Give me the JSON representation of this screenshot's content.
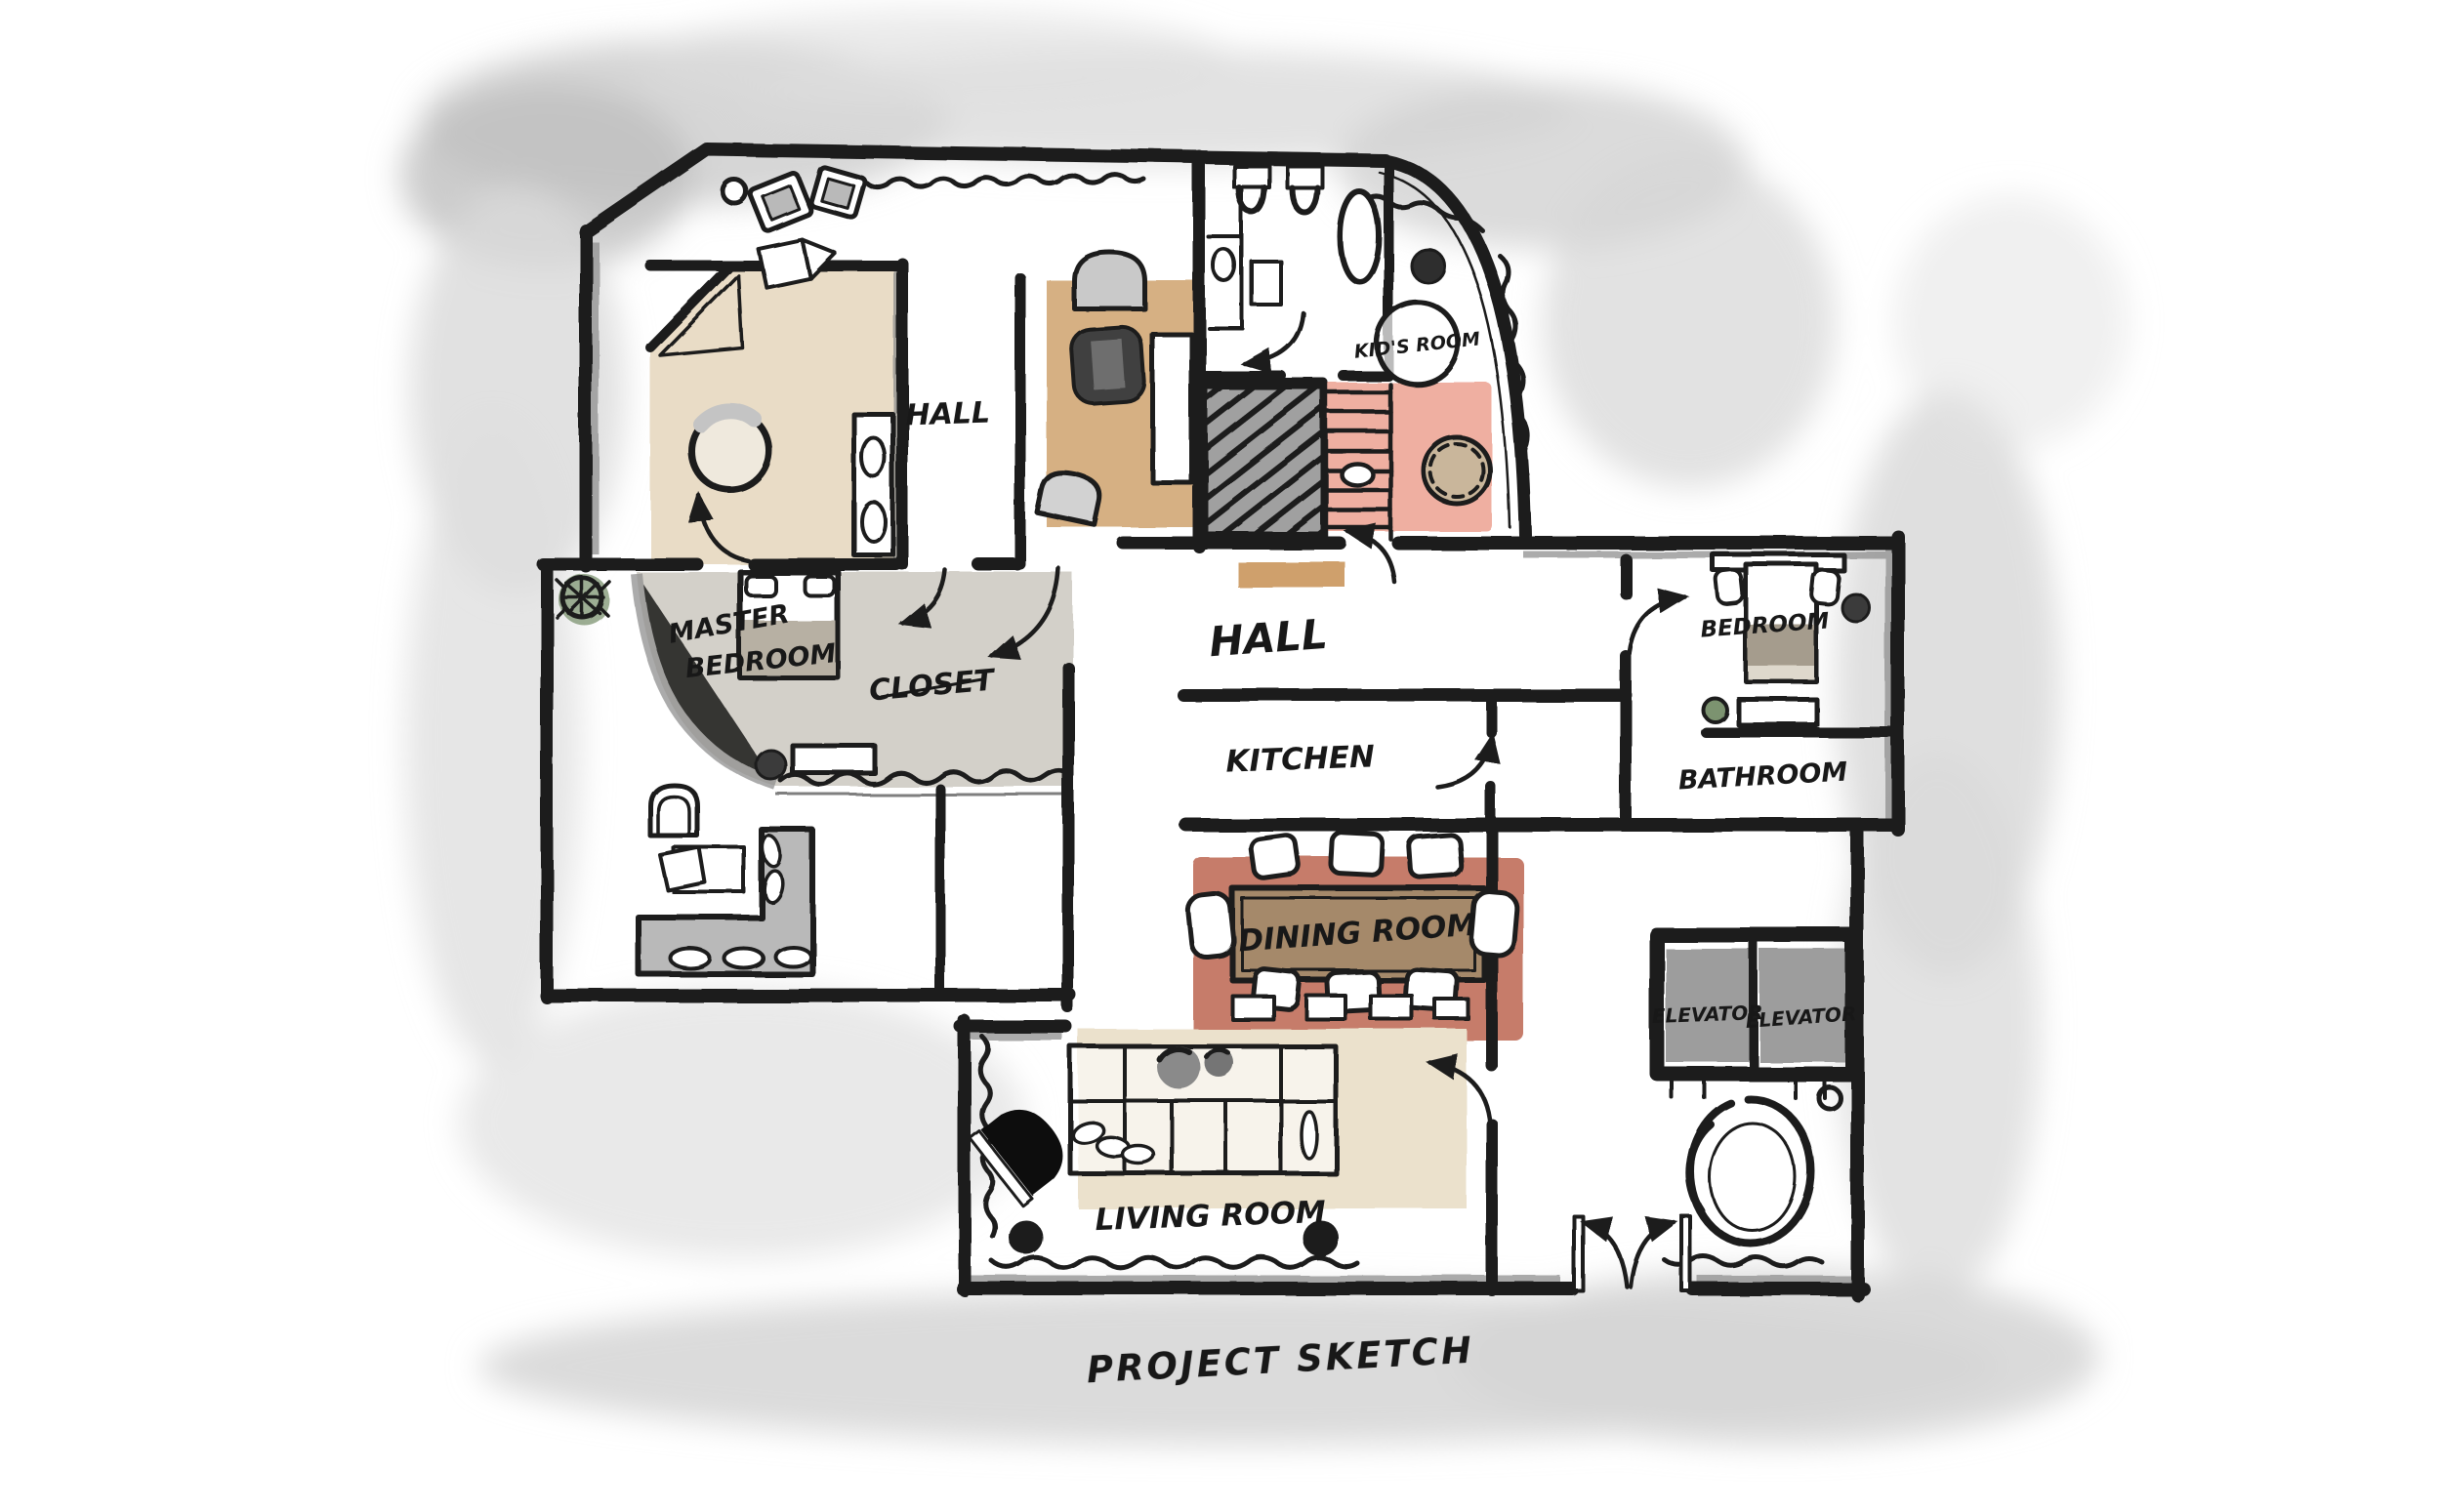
{
  "caption": "PROJECT SKETCH",
  "rooms": {
    "hall_upper": {
      "label": "HALL"
    },
    "kids_room": {
      "label": "KID'S ROOM"
    },
    "master_bedroom": {
      "line1": "MASTER",
      "line2": "BEDROOM"
    },
    "closet": {
      "label": "CLOSET"
    },
    "hall_center": {
      "label": "HALL"
    },
    "kitchen": {
      "label": "KITCHEN"
    },
    "bedroom": {
      "label": "BEDROOM"
    },
    "bathroom": {
      "label": "BATHROOM"
    },
    "dining_room": {
      "label": "DINING ROOM"
    },
    "living_room": {
      "label": "LIVING ROOM"
    },
    "elevator_left": {
      "label": "ELEVATOR"
    },
    "elevator_right": {
      "label": "ELEVATOR"
    }
  },
  "palette": {
    "wall_ink": "#1d1d1d",
    "floor_beige": "#e9dcc6",
    "rug_tan": "#d6b083",
    "rug_pink": "#efafa1",
    "rug_red": "#c67c6b",
    "rug_cream": "#ebe1cc",
    "table_brown": "#a5896b",
    "floor_gray": "#d3d0c9",
    "plant_green": "#7c9370",
    "watercolor_gray": "#d6d6d6"
  }
}
